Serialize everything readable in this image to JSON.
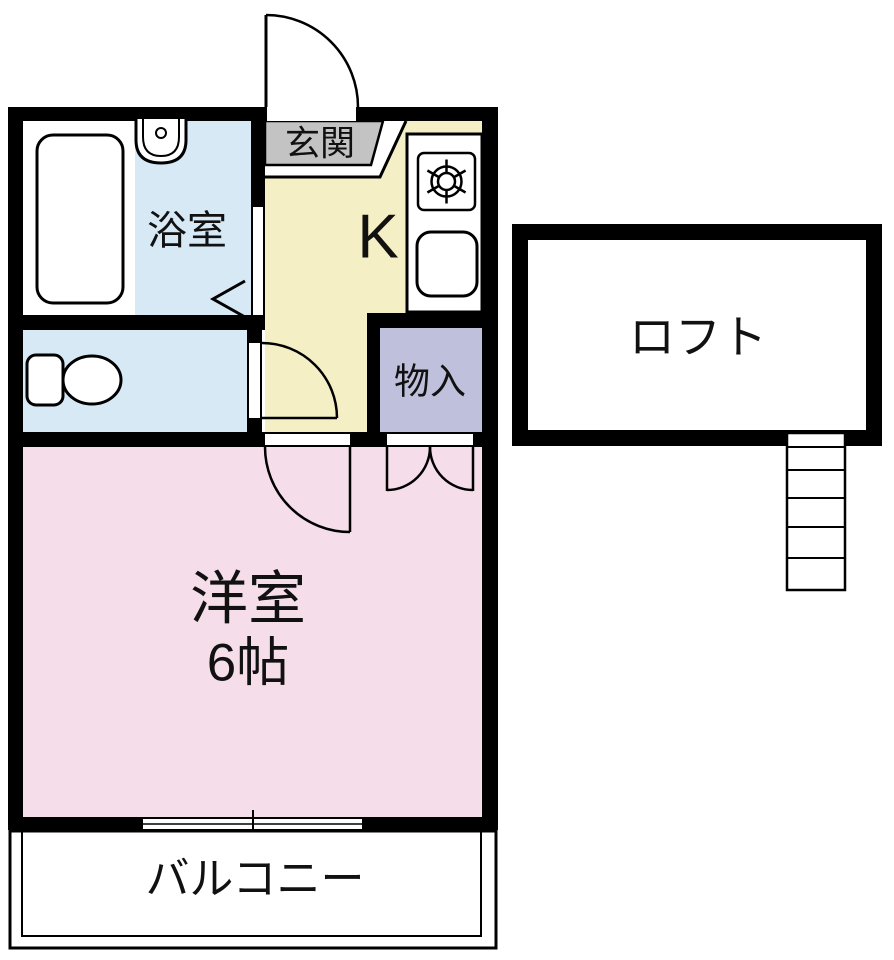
{
  "title": "1K apartment floor plan with loft",
  "labels": {
    "genkan": "玄関",
    "bathroom": "浴室",
    "kitchen": "K",
    "storage": "物入",
    "western_room": "洋室",
    "western_room_size": "6帖",
    "loft": "ロフト",
    "balcony": "バルコニー"
  },
  "colors": {
    "wall": "#000000",
    "genkan_floor": "#c3c3c3",
    "bathroom_floor": "#d7e9f5",
    "toilet_floor": "#d7e9f5",
    "kitchen_floor": "#f5efc5",
    "storage_floor": "#bec0dc",
    "western_room_floor": "#f5dde9",
    "fixture_fill": "#ffffff",
    "line": "#000000"
  }
}
